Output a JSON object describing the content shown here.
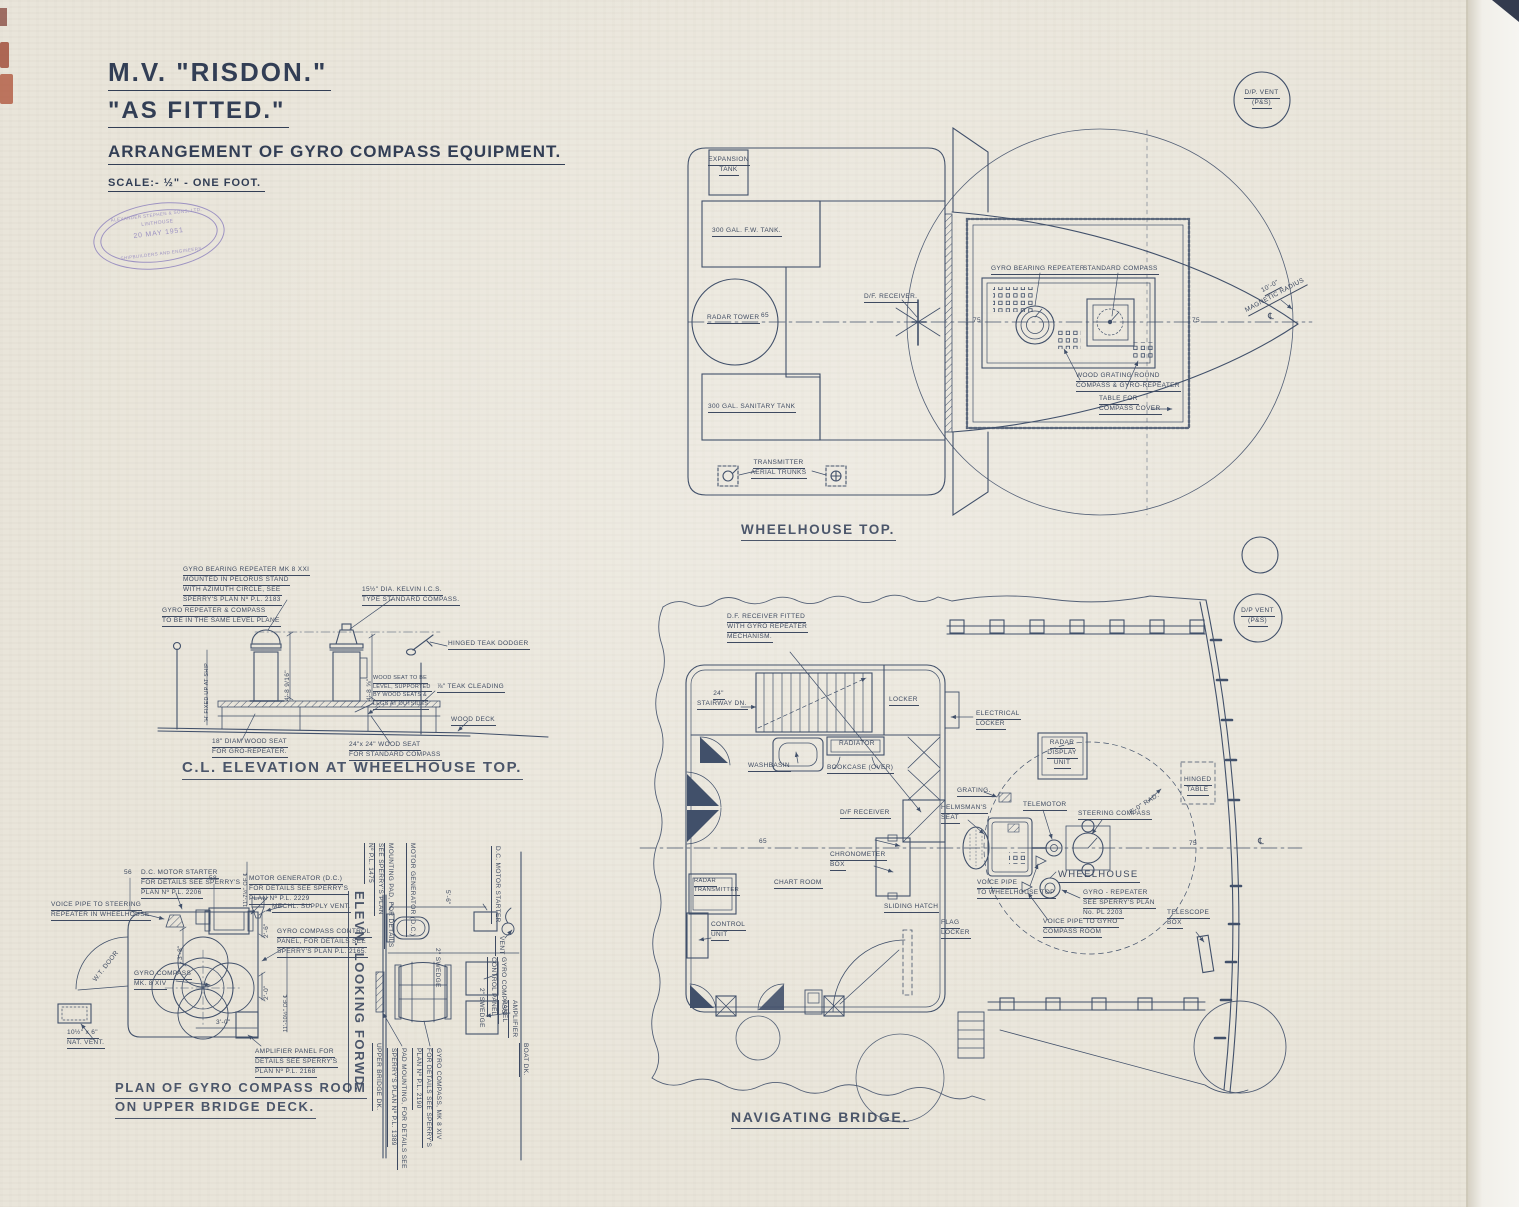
{
  "title_block": {
    "ship": "M.V. \"RISDON.\"",
    "fitted": "\"AS FITTED.\"",
    "drawing_title": "ARRANGEMENT OF GYRO COMPASS EQUIPMENT.",
    "scale": "SCALE:- ½\" - ONE FOOT.",
    "stamp": {
      "company": "ALEXANDER STEPHEN & SONS, LTD.",
      "place": "LINTHOUSE",
      "date": "20 MAY 1951",
      "trade": "SHIPBUILDERS AND ENGINEERS"
    }
  },
  "wheelhouse_top": {
    "title": "WHEELHOUSE TOP.",
    "expansion_tank": [
      "EXPANSION",
      "TANK"
    ],
    "fw_tank": "300 GAL. F.W. TANK.",
    "radar_tower": "RADAR TOWER",
    "sanitary_tank": "300 GAL. SANITARY TANK",
    "transmitter": [
      "TRANSMITTER",
      "AERIAL TRUNKS"
    ],
    "df_receiver": "D/F. RECEIVER.",
    "gyro_bearing_repeater": "GYRO BEARING REPEATER",
    "standard_compass": "STANDARD COMPASS",
    "wood_grating": [
      "WOOD GRATING ROUND",
      "COMPASS & GYRO-REPEATER"
    ],
    "table_cover": [
      "TABLE FOR",
      "COMPASS COVER"
    ],
    "magnetic_radius": [
      "10'-0\"",
      "MAGNETIC RADIUS"
    ],
    "dp_vent": [
      "D/P. VENT",
      "(P&S)"
    ],
    "frame_65": "65",
    "frame_75a": "75",
    "frame_75b": "75",
    "centerline_symbol": "℄"
  },
  "elevation": {
    "title": "C.L. ELEVATION AT WHEELHOUSE TOP.",
    "repeater_note": [
      "GYRO BEARING REPEATER MK 8 XXI",
      "MOUNTED IN PELORUS STAND",
      "WITH AZIMUTH CIRCLE, SEE",
      "SPERRY'S PLAN Nº P.L. 2183"
    ],
    "kelvin_note": [
      "15½\" DIA. KELVIN I.C.S.",
      "TYPE STANDARD COMPASS."
    ],
    "level_note": [
      "GYRO REPEATER & COMPASS",
      "TO BE IN THE SAME LEVEL PLANE"
    ],
    "dodger": "HINGED TEAK DODGER",
    "wood_seat_note": [
      "WOOD SEAT TO BE",
      "LEVEL, SUPPORTED",
      "BY WOOD SEATS &",
      "LEGS AT OUTSIDES"
    ],
    "cleading": "⅞\" TEAK CLEADING",
    "wood_deck": "WOOD DECK",
    "seat_18": [
      "18\" DIAM WOOD SEAT",
      "FOR GRO-REPEATER."
    ],
    "seat_24": [
      "24\"x 24\" WOOD SEAT",
      "FOR STANDARD COMPASS"
    ],
    "dim_left": "4'-8 9/16\"",
    "dim_right": "4'-8 ⅝\"",
    "h_fixed": "'H' FIXED UP AT SHIP"
  },
  "gyro_room": {
    "title": [
      "PLAN OF GYRO COMPASS ROOM",
      "ON UPPER BRIDGE DECK."
    ],
    "dc_starter": [
      "D.C. MOTOR STARTER",
      "FOR DETAILS SEE SPERRY'S",
      "PLAN Nº P.L. 2206"
    ],
    "motor_gen": [
      "MOTOR GENERATOR (D.C.)",
      "FOR DETAILS SEE SPERRY'S",
      "PLAN Nº P.L. 2229"
    ],
    "mech_vent": "MECHL. SUPPLY VENT.",
    "voice_pipe": [
      "VOICE PIPE TO STEERING",
      "REPEATER IN WHEELHOUSE"
    ],
    "control_panel": [
      "GYRO COMPASS CONTROL",
      "PANEL, FOR DETAILS SEE",
      "SPERRY'S PLAN P.L. 2165."
    ],
    "gyro_compass": [
      "GYRO COMPASS",
      "MK. 8 XIV"
    ],
    "amplifier": [
      "AMPLIFIER PANEL FOR",
      "DETAILS SEE SPERRY'S",
      "PLAN Nº P.L. 2168"
    ],
    "nat_vent": [
      "10½\" x 6\"",
      "NAT. VENT."
    ],
    "wt_door": "W.T. DOOR",
    "frame_56": "56",
    "frame_58": "58",
    "dim_3_8": "3'-8\"",
    "dim_2_6": "2'-6\"",
    "dim_2_0": "2'-0\"",
    "dim_3_0": "3'-0\"",
    "dim_11_10": "11'-10½\" OF ℄",
    "dim_11_7": "11'-7½\" OF ℄"
  },
  "elev_forward": {
    "title": "ELEVN. LOOKING FORWD.",
    "motor_gen": "MOTOR GENERATOR (D.C.)",
    "dc_starter": "D.C. MOTOR STARTER",
    "mounting_pad": [
      "MOUNTING PAD, FOR DETAILS",
      "SEE SPERRY'S PLAN",
      "Nº P.L. 1475"
    ],
    "dim_5_6": "5'-6\"",
    "swedge1": "2\" SWEDGE",
    "swedge2": "2\" SWEDGE",
    "vent": "VENT",
    "control_panel": [
      "GYRO COMPASS",
      "CONTROL PANEL"
    ],
    "amplifier": [
      "AMPLIFIER",
      "PANEL"
    ],
    "gyro_compass": [
      "GYRO COMPASS, MK 8 XIV",
      "FOR DETAILS SEE SPERRY'S",
      "PLAN Nº P.L. 2190"
    ],
    "pad_mounting": [
      "PAD MOUNTING, FOR DETAILS SEE",
      "SPERRY'S PLAN Nº P.L. 1389"
    ],
    "upper_deck": "UPPER BRIDGE DK.",
    "boat_deck": "BOAT DK."
  },
  "nav_bridge": {
    "title": "NAVIGATING BRIDGE.",
    "df_fitted": [
      "D.F. RECEIVER FITTED",
      "WITH GYRO REPEATER",
      "MECHANISM."
    ],
    "stairway": [
      "24\"",
      "STAIRWAY DN."
    ],
    "locker": "LOCKER",
    "radiator": "RADIATOR",
    "washbasin": "WASHBASIN",
    "bookcase": "BOOKCASE (OVER)",
    "df_receiver": "D/F RECEIVER",
    "chronometer": [
      "CHRONOMETER",
      "BOX"
    ],
    "chart_room": "CHART ROOM",
    "radar_transmitter": [
      "RADAR",
      "TRANSMITTER"
    ],
    "control_unit": [
      "CONTROL",
      "UNIT"
    ],
    "sliding_hatch": "SLIDING HATCH",
    "flag_locker": [
      "FLAG",
      "LOCKER"
    ],
    "electrical_locker": [
      "ELECTRICAL",
      "LOCKER"
    ],
    "radar_display": [
      "RADAR",
      "DISPLAY",
      "UNIT"
    ],
    "grating": "GRATING.",
    "helmsman": [
      "HELMSMAN'S",
      "SEAT"
    ],
    "telemotor": "TELEMOTOR",
    "steering_compass": "STEERING COMPASS",
    "radius": "8'-0\" RAD.",
    "hinged_table": [
      "HINGED",
      "TABLE"
    ],
    "wheelhouse": "WHEELHOUSE",
    "gyro_repeater": [
      "GYRO - REPEATER",
      "SEE SPERRY'S PLAN",
      "No. PL 2203"
    ],
    "voice_pipe_top": [
      "VOICE PIPE",
      "TO WHEELHOUSE TOP"
    ],
    "voice_pipe_gyro": [
      "VOICE PIPE TO GYRO",
      "COMPASS ROOM"
    ],
    "telescope": [
      "TELESCOPE",
      "BOX"
    ],
    "dp_vent": [
      "D/P VENT",
      "(P&S)"
    ],
    "frame_65": "65",
    "frame_75": "75",
    "centerline_symbol": "℄"
  }
}
